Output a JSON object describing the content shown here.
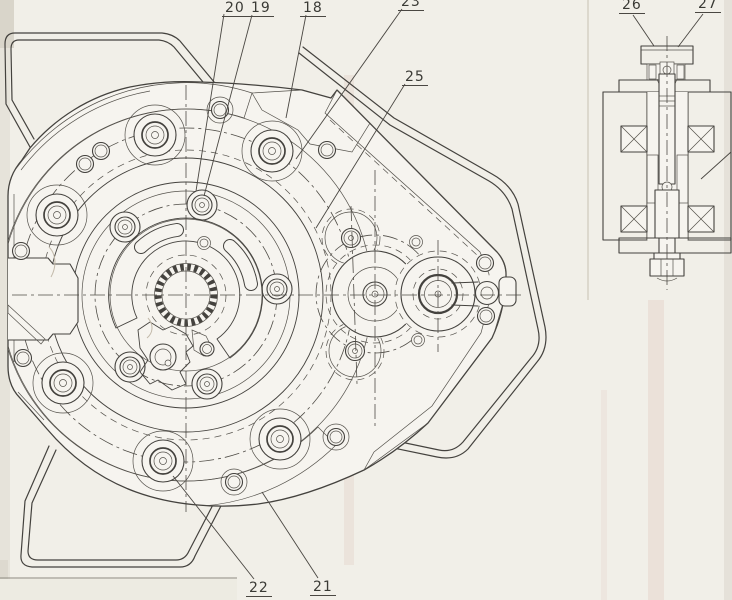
{
  "colors": {
    "paper": "#f1efe8",
    "housing_fill": "#f6f4ef",
    "line": "#44423e",
    "label_text": "#3a3a35"
  },
  "callouts": [
    {
      "id": "18",
      "label": "18"
    },
    {
      "id": "19",
      "label": "19"
    },
    {
      "id": "20",
      "label": "20"
    },
    {
      "id": "21",
      "label": "21"
    },
    {
      "id": "22",
      "label": "22"
    },
    {
      "id": "23",
      "label": "23"
    },
    {
      "id": "25",
      "label": "25"
    },
    {
      "id": "26",
      "label": "26"
    },
    {
      "id": "27",
      "label": "27"
    }
  ]
}
